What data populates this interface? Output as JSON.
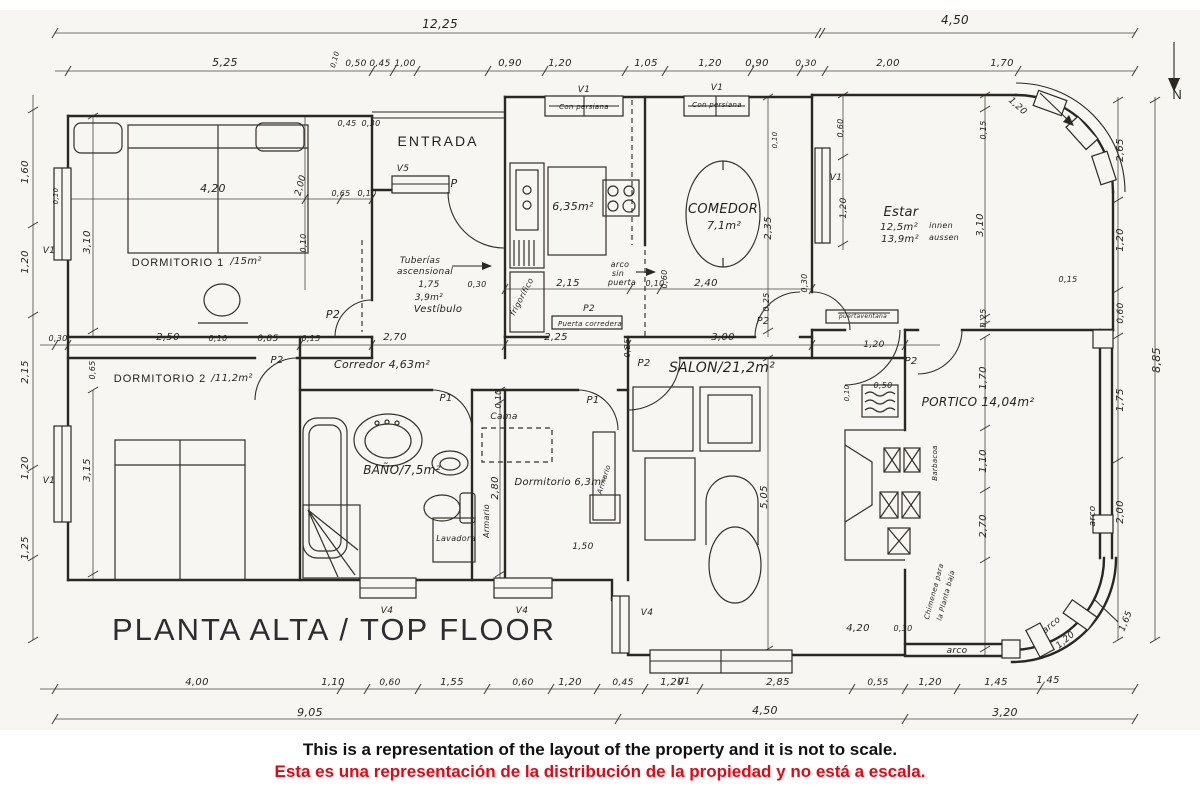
{
  "page": {
    "title": "PLANTA ALTA  /  TOP FLOOR",
    "disclaimer_en": "This is a representation of the layout of the property and it is not to scale.",
    "disclaimer_es": "Esta es una representación de la distribución de la propiedad y no está a escala."
  },
  "colors": {
    "ink": "#2b2823",
    "accent_red": "#e30613",
    "paper": "#f7f6f2"
  },
  "plan_labels": [
    {
      "n": "dim-overall-top-left",
      "t": "12,25",
      "x": 440,
      "y": 28,
      "s": 12
    },
    {
      "n": "dim-overall-top-right",
      "t": "4,50",
      "x": 955,
      "y": 24,
      "s": 12
    },
    {
      "n": "dim-top",
      "t": "5,25",
      "x": 225,
      "y": 66,
      "s": 11
    },
    {
      "n": "dim-top",
      "t": "0,10",
      "x": 337,
      "y": 60,
      "s": 7,
      "r": -75
    },
    {
      "n": "dim-top",
      "t": "0,50",
      "x": 356,
      "y": 66,
      "s": 9
    },
    {
      "n": "dim-top",
      "t": "0,45",
      "x": 380,
      "y": 66,
      "s": 9
    },
    {
      "n": "dim-top",
      "t": "1,00",
      "x": 405,
      "y": 66,
      "s": 9
    },
    {
      "n": "dim-top",
      "t": "0,90",
      "x": 510,
      "y": 66,
      "s": 10
    },
    {
      "n": "dim-top",
      "t": "1,20",
      "x": 560,
      "y": 66,
      "s": 10
    },
    {
      "n": "dim-top",
      "t": "1,05",
      "x": 646,
      "y": 66,
      "s": 10
    },
    {
      "n": "dim-top",
      "t": "1,20",
      "x": 710,
      "y": 66,
      "s": 10
    },
    {
      "n": "dim-top",
      "t": "0,90",
      "x": 757,
      "y": 66,
      "s": 10
    },
    {
      "n": "dim-top",
      "t": "0,30",
      "x": 806,
      "y": 66,
      "s": 9
    },
    {
      "n": "dim-top",
      "t": "2,00",
      "x": 888,
      "y": 66,
      "s": 10
    },
    {
      "n": "dim-top",
      "t": "1,70",
      "x": 1002,
      "y": 66,
      "s": 10
    },
    {
      "n": "north-label",
      "t": "N",
      "x": 1178,
      "y": 99,
      "s": 13,
      "c": "caps"
    },
    {
      "n": "dim-left",
      "t": "1,60",
      "x": 28,
      "y": 172,
      "s": 10,
      "r": -90
    },
    {
      "n": "dim-left",
      "t": "1,20",
      "x": 28,
      "y": 262,
      "s": 10,
      "r": -90
    },
    {
      "n": "dim-left",
      "t": "2,15",
      "x": 28,
      "y": 372,
      "s": 10,
      "r": -90
    },
    {
      "n": "dim-left",
      "t": "1,20",
      "x": 28,
      "y": 468,
      "s": 10,
      "r": -90
    },
    {
      "n": "dim-left",
      "t": "1,25",
      "x": 28,
      "y": 548,
      "s": 10,
      "r": -90
    },
    {
      "n": "dim-right",
      "t": "2,65",
      "x": 1123,
      "y": 150,
      "s": 10,
      "r": -90
    },
    {
      "n": "dim-right",
      "t": "1,20",
      "x": 1123,
      "y": 240,
      "s": 10,
      "r": -90
    },
    {
      "n": "dim-right",
      "t": "0,60",
      "x": 1123,
      "y": 313,
      "s": 9,
      "r": -90
    },
    {
      "n": "dim-right",
      "t": "1,75",
      "x": 1123,
      "y": 400,
      "s": 10,
      "r": -90
    },
    {
      "n": "dim-right",
      "t": "2,00",
      "x": 1123,
      "y": 512,
      "s": 10,
      "r": -90
    },
    {
      "n": "dim-right-overall",
      "t": "8,85",
      "x": 1160,
      "y": 360,
      "s": 11,
      "r": -90
    },
    {
      "n": "dim-right",
      "t": "1,65",
      "x": 1128,
      "y": 622,
      "s": 9,
      "r": -68
    },
    {
      "n": "dim-bottom",
      "t": "4,00",
      "x": 197,
      "y": 685,
      "s": 10
    },
    {
      "n": "dim-bottom",
      "t": "1,10",
      "x": 333,
      "y": 685,
      "s": 10
    },
    {
      "n": "dim-bottom",
      "t": "0,60",
      "x": 390,
      "y": 685,
      "s": 9
    },
    {
      "n": "dim-bottom",
      "t": "1,55",
      "x": 452,
      "y": 685,
      "s": 10
    },
    {
      "n": "dim-bottom",
      "t": "0,60",
      "x": 523,
      "y": 685,
      "s": 9
    },
    {
      "n": "dim-bottom",
      "t": "1,20",
      "x": 570,
      "y": 685,
      "s": 10
    },
    {
      "n": "dim-bottom",
      "t": "0,45",
      "x": 623,
      "y": 685,
      "s": 9
    },
    {
      "n": "dim-bottom",
      "t": "1,20",
      "x": 672,
      "y": 685,
      "s": 10
    },
    {
      "n": "dim-bottom",
      "t": "2,85",
      "x": 778,
      "y": 685,
      "s": 10
    },
    {
      "n": "dim-bottom",
      "t": "0,55",
      "x": 878,
      "y": 685,
      "s": 9
    },
    {
      "n": "dim-bottom",
      "t": "1,20",
      "x": 930,
      "y": 685,
      "s": 10
    },
    {
      "n": "dim-bottom",
      "t": "1,45",
      "x": 996,
      "y": 685,
      "s": 10
    },
    {
      "n": "dim-bottom-overall",
      "t": "9,05",
      "x": 310,
      "y": 716,
      "s": 11
    },
    {
      "n": "dim-bottom-overall",
      "t": "4,50",
      "x": 765,
      "y": 714,
      "s": 11
    },
    {
      "n": "dim-bottom-overall",
      "t": "3,20",
      "x": 1005,
      "y": 716,
      "s": 11
    },
    {
      "n": "room-label-dormitorio1",
      "t": "DORMITORIO 1",
      "x": 178,
      "y": 266,
      "s": 11,
      "c": "smallcaps"
    },
    {
      "n": "room-area-dormitorio1",
      "t": "/15m²",
      "x": 246,
      "y": 264,
      "s": 10
    },
    {
      "n": "dim",
      "t": "4,20",
      "x": 213,
      "y": 192,
      "s": 11
    },
    {
      "n": "dim",
      "t": "3,10",
      "x": 90,
      "y": 242,
      "s": 10,
      "r": -90
    },
    {
      "n": "dim",
      "t": "2,00",
      "x": 303,
      "y": 186,
      "s": 9,
      "r": -75
    },
    {
      "n": "dim",
      "t": "0,10",
      "x": 306,
      "y": 243,
      "s": 8,
      "r": -90
    },
    {
      "n": "dim",
      "t": "0,10",
      "x": 58,
      "y": 196,
      "s": 7,
      "r": -90
    },
    {
      "n": "dim",
      "t": "0,45",
      "x": 347,
      "y": 126,
      "s": 8
    },
    {
      "n": "dim",
      "t": "0,30",
      "x": 371,
      "y": 126,
      "s": 8
    },
    {
      "n": "dim",
      "t": "0,65",
      "x": 341,
      "y": 196,
      "s": 8
    },
    {
      "n": "dim",
      "t": "0,10",
      "x": 367,
      "y": 196,
      "s": 8
    },
    {
      "n": "door-label",
      "t": "P2",
      "x": 333,
      "y": 318,
      "s": 11
    },
    {
      "n": "dim-mid",
      "t": "0,30",
      "x": 58,
      "y": 341,
      "s": 8
    },
    {
      "n": "dim-mid",
      "t": "2,50",
      "x": 168,
      "y": 340,
      "s": 10
    },
    {
      "n": "dim-mid",
      "t": "0,10",
      "x": 218,
      "y": 341,
      "s": 8
    },
    {
      "n": "dim-mid",
      "t": "0,85",
      "x": 268,
      "y": 341,
      "s": 9
    },
    {
      "n": "dim-mid",
      "t": "0,15",
      "x": 311,
      "y": 341,
      "s": 8
    },
    {
      "n": "dim-mid",
      "t": "2,70",
      "x": 395,
      "y": 340,
      "s": 10
    },
    {
      "n": "dim-mid",
      "t": "2,25",
      "x": 556,
      "y": 340,
      "s": 10
    },
    {
      "n": "dim-mid",
      "t": "0,25",
      "x": 630,
      "y": 348,
      "s": 8,
      "r": -90
    },
    {
      "n": "dim-mid",
      "t": "3,00",
      "x": 723,
      "y": 340,
      "s": 10
    },
    {
      "n": "dim-door-swing",
      "t": "1,20",
      "x": 874,
      "y": 347,
      "s": 9
    },
    {
      "n": "dim",
      "t": "0,65",
      "x": 95,
      "y": 370,
      "s": 8,
      "r": -90
    },
    {
      "n": "dim",
      "t": "3,15",
      "x": 90,
      "y": 470,
      "s": 10,
      "r": -90
    },
    {
      "n": "room-label-dormitorio2",
      "t": "DORMITORIO 2",
      "x": 160,
      "y": 382,
      "s": 11,
      "c": "smallcaps"
    },
    {
      "n": "room-area-dormitorio2",
      "t": "/11,2m²",
      "x": 232,
      "y": 381,
      "s": 10
    },
    {
      "n": "door-label",
      "t": "P2",
      "x": 277,
      "y": 363,
      "s": 10
    },
    {
      "n": "room-label-corredor",
      "t": "Corredor 4,63m²",
      "x": 382,
      "y": 368,
      "s": 11
    },
    {
      "n": "room-label-entrada",
      "t": "ENTRADA",
      "x": 438,
      "y": 146,
      "s": 14,
      "c": "caps"
    },
    {
      "n": "window-label",
      "t": "V5",
      "x": 403,
      "y": 171,
      "s": 9
    },
    {
      "n": "door-label",
      "t": "P",
      "x": 454,
      "y": 187,
      "s": 11
    },
    {
      "n": "note-tuberias-1",
      "t": "Tuberías",
      "x": 420,
      "y": 263,
      "s": 9
    },
    {
      "n": "note-tuberias-2",
      "t": "ascensional",
      "x": 425,
      "y": 274,
      "s": 9
    },
    {
      "n": "dim",
      "t": "1,75",
      "x": 429,
      "y": 287,
      "s": 9
    },
    {
      "n": "dim",
      "t": "0,30",
      "x": 477,
      "y": 287,
      "s": 8
    },
    {
      "n": "room-area-vestibulo",
      "t": "3,9m²",
      "x": 429,
      "y": 300,
      "s": 9
    },
    {
      "n": "room-label-vestibulo",
      "t": "Vestíbulo",
      "x": 438,
      "y": 312,
      "s": 10
    },
    {
      "n": "room-area-cocina",
      "t": "6,35m²",
      "x": 573,
      "y": 210,
      "s": 11
    },
    {
      "n": "note-frigorifico",
      "t": "frigorífico",
      "x": 524,
      "y": 298,
      "s": 8,
      "r": -62
    },
    {
      "n": "dim",
      "t": "2,15",
      "x": 568,
      "y": 286,
      "s": 10
    },
    {
      "n": "note-arco-1",
      "t": "arco",
      "x": 620,
      "y": 267,
      "s": 8
    },
    {
      "n": "note-arco-2",
      "t": "sin",
      "x": 618,
      "y": 276,
      "s": 8
    },
    {
      "n": "note-arco-3",
      "t": "puerta",
      "x": 622,
      "y": 285,
      "s": 8
    },
    {
      "n": "dim",
      "t": "0,10",
      "x": 655,
      "y": 286,
      "s": 8
    },
    {
      "n": "dim",
      "t": "0,60",
      "x": 667,
      "y": 279,
      "s": 8,
      "r": -90
    },
    {
      "n": "dim",
      "t": "2,40",
      "x": 706,
      "y": 286,
      "s": 10
    },
    {
      "n": "window-label",
      "t": "V1",
      "x": 584,
      "y": 92,
      "s": 9
    },
    {
      "n": "window-note",
      "t": "Con persiana",
      "x": 584,
      "y": 109,
      "s": 7
    },
    {
      "n": "window-label",
      "t": "V1",
      "x": 717,
      "y": 90,
      "s": 9
    },
    {
      "n": "window-note",
      "t": "Con persiana",
      "x": 717,
      "y": 107,
      "s": 7
    },
    {
      "n": "room-label-comedor",
      "t": "COMEDOR",
      "x": 723,
      "y": 213,
      "s": 13
    },
    {
      "n": "room-area-comedor",
      "t": "7,1m²",
      "x": 724,
      "y": 229,
      "s": 11
    },
    {
      "n": "dim",
      "t": "2,35",
      "x": 771,
      "y": 228,
      "s": 10,
      "r": -90
    },
    {
      "n": "dim",
      "t": "0,25",
      "x": 769,
      "y": 302,
      "s": 8,
      "r": -90
    },
    {
      "n": "door-label",
      "t": "P2",
      "x": 763,
      "y": 324,
      "s": 10
    },
    {
      "n": "dim",
      "t": "0,10",
      "x": 777,
      "y": 140,
      "s": 7,
      "r": -90
    },
    {
      "n": "dim",
      "t": "0,30",
      "x": 807,
      "y": 283,
      "s": 8,
      "r": -90
    },
    {
      "n": "room-label-estar",
      "t": "Estar",
      "x": 901,
      "y": 216,
      "s": 13
    },
    {
      "n": "room-area-estar-1",
      "t": "12,5m²",
      "x": 899,
      "y": 230,
      "s": 10
    },
    {
      "n": "room-note-estar-1",
      "t": "innen",
      "x": 941,
      "y": 228,
      "s": 8
    },
    {
      "n": "room-area-estar-2",
      "t": "13,9m²",
      "x": 900,
      "y": 242,
      "s": 10
    },
    {
      "n": "room-note-estar-2",
      "t": "aussen",
      "x": 944,
      "y": 240,
      "s": 8
    },
    {
      "n": "window-label",
      "t": "V1",
      "x": 836,
      "y": 180,
      "s": 9
    },
    {
      "n": "dim",
      "t": "1,20",
      "x": 846,
      "y": 208,
      "s": 9,
      "r": -90
    },
    {
      "n": "dim",
      "t": "0,60",
      "x": 843,
      "y": 128,
      "s": 8,
      "r": -90
    },
    {
      "n": "dim",
      "t": "0,15",
      "x": 986,
      "y": 130,
      "s": 8,
      "r": -90
    },
    {
      "n": "dim",
      "t": "3,10",
      "x": 983,
      "y": 225,
      "s": 10,
      "r": -90
    },
    {
      "n": "dim",
      "t": "0,25",
      "x": 986,
      "y": 318,
      "s": 8,
      "r": -90
    },
    {
      "n": "door-note-puertaventana",
      "t": "puertaventana",
      "x": 863,
      "y": 318,
      "s": 6
    },
    {
      "n": "dim-corner",
      "t": "1,20",
      "x": 1016,
      "y": 108,
      "s": 9,
      "r": 42
    },
    {
      "n": "dim",
      "t": "0,15",
      "x": 1068,
      "y": 282,
      "s": 8
    },
    {
      "n": "room-label-salon",
      "t": "SALON/21,2m²",
      "x": 722,
      "y": 372,
      "s": 14
    },
    {
      "n": "dim",
      "t": "5,05",
      "x": 767,
      "y": 497,
      "s": 10,
      "r": -90
    },
    {
      "n": "door-label",
      "t": "P2",
      "x": 644,
      "y": 366,
      "s": 10
    },
    {
      "n": "door-label",
      "t": "P2",
      "x": 911,
      "y": 364,
      "s": 10
    },
    {
      "n": "dim",
      "t": "0,50",
      "x": 883,
      "y": 388,
      "s": 8
    },
    {
      "n": "dim",
      "t": "0,10",
      "x": 849,
      "y": 393,
      "s": 7,
      "r": -90
    },
    {
      "n": "dim",
      "t": "4,20",
      "x": 858,
      "y": 631,
      "s": 10
    },
    {
      "n": "dim",
      "t": "0,30",
      "x": 903,
      "y": 631,
      "s": 8
    },
    {
      "n": "room-label-portico",
      "t": "PORTICO  14,04m²",
      "x": 978,
      "y": 406,
      "s": 12
    },
    {
      "n": "dim",
      "t": "1,70",
      "x": 986,
      "y": 378,
      "s": 10,
      "r": -90
    },
    {
      "n": "dim",
      "t": "1,10",
      "x": 986,
      "y": 461,
      "s": 10,
      "r": -90
    },
    {
      "n": "dim",
      "t": "2,70",
      "x": 986,
      "y": 526,
      "s": 10,
      "r": -90
    },
    {
      "n": "note-barbacoa",
      "t": "Barbacoa",
      "x": 937,
      "y": 463,
      "s": 7,
      "r": -90
    },
    {
      "n": "note-chimenea-1",
      "t": "Chimenea para",
      "x": 936,
      "y": 592,
      "s": 7,
      "r": -75
    },
    {
      "n": "note-chimenea-2",
      "t": "la Planta baja",
      "x": 948,
      "y": 596,
      "s": 7,
      "r": -75
    },
    {
      "n": "note-arco-wall",
      "t": "arco",
      "x": 1095,
      "y": 516,
      "s": 9,
      "r": -90
    },
    {
      "n": "note-arco-bottom",
      "t": "arco",
      "x": 957,
      "y": 653,
      "s": 9
    },
    {
      "n": "note-arco-corner",
      "t": "arco",
      "x": 1053,
      "y": 627,
      "s": 9,
      "r": -40
    },
    {
      "n": "dim-corner",
      "t": "1,20",
      "x": 1067,
      "y": 642,
      "s": 9,
      "r": -40
    },
    {
      "n": "dim",
      "t": "1,45",
      "x": 1048,
      "y": 683,
      "s": 10
    },
    {
      "n": "room-label-dormitorio3",
      "t": "Dormitorio 6,3m²",
      "x": 560,
      "y": 485,
      "s": 10
    },
    {
      "n": "note-cama",
      "t": "Cama",
      "x": 504,
      "y": 419,
      "s": 9
    },
    {
      "n": "door-label",
      "t": "P1",
      "x": 593,
      "y": 403,
      "s": 10
    },
    {
      "n": "note-armario-right",
      "t": "Armario",
      "x": 606,
      "y": 480,
      "s": 7,
      "r": -72
    },
    {
      "n": "dim",
      "t": "1,50",
      "x": 583,
      "y": 549,
      "s": 9
    },
    {
      "n": "dim",
      "t": "0,10",
      "x": 501,
      "y": 399,
      "s": 8,
      "r": -90
    },
    {
      "n": "dim",
      "t": "2,80",
      "x": 498,
      "y": 488,
      "s": 10,
      "r": -90
    },
    {
      "n": "note-armario-left",
      "t": "Armario",
      "x": 489,
      "y": 521,
      "s": 8,
      "r": -90
    },
    {
      "n": "room-label-bano",
      "t": "BAÑO/7,5m²",
      "x": 402,
      "y": 474,
      "s": 12
    },
    {
      "n": "door-label",
      "t": "P1",
      "x": 446,
      "y": 401,
      "s": 10
    },
    {
      "n": "note-lavadora",
      "t": "Lavadora",
      "x": 456,
      "y": 541,
      "s": 8
    },
    {
      "n": "window-label",
      "t": "V4",
      "x": 387,
      "y": 613,
      "s": 9
    },
    {
      "n": "window-label",
      "t": "V4",
      "x": 522,
      "y": 613,
      "s": 9
    },
    {
      "n": "window-label",
      "t": "V4",
      "x": 647,
      "y": 615,
      "s": 9
    },
    {
      "n": "window-label",
      "t": "V1",
      "x": 684,
      "y": 684,
      "s": 9
    },
    {
      "n": "window-label",
      "t": "V1",
      "x": 49,
      "y": 253,
      "s": 9
    },
    {
      "n": "window-label",
      "t": "V1",
      "x": 49,
      "y": 483,
      "s": 9
    },
    {
      "n": "door-label",
      "t": "P2",
      "x": 589,
      "y": 311,
      "s": 9
    },
    {
      "n": "door-note-corredera",
      "t": "Puerta corredera",
      "x": 590,
      "y": 326,
      "s": 7
    }
  ]
}
